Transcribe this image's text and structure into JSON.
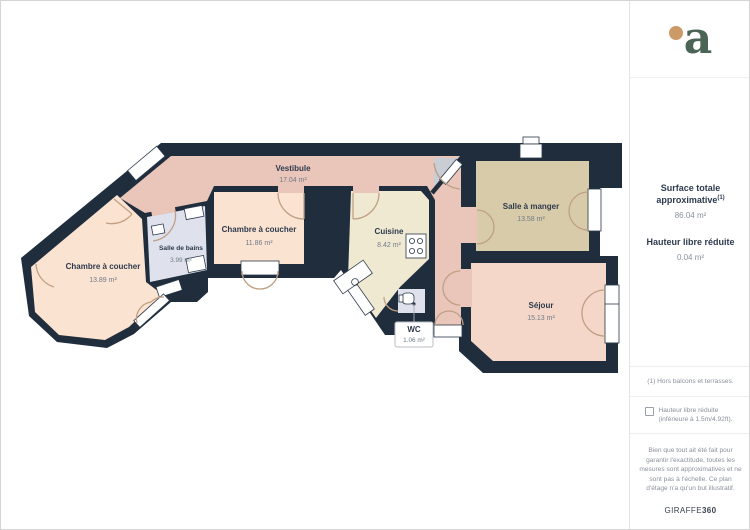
{
  "rooms": [
    {
      "name": "Vestibule",
      "area": "17.04 m²"
    },
    {
      "name": "Chambre à coucher",
      "area": "11.86 m²"
    },
    {
      "name": "Chambre à coucher",
      "area": "13.89 m²"
    },
    {
      "name": "Salle de bains",
      "area": "3.99 m²"
    },
    {
      "name": "Cuisine",
      "area": "8.42 m²"
    },
    {
      "name": "Salle à manger",
      "area": "13.58 m²"
    },
    {
      "name": "Séjour",
      "area": "15.13 m²"
    },
    {
      "name": "WC",
      "area": "1.06 m²"
    }
  ],
  "sidebar": {
    "logo_letter": "a",
    "surface_label": "Surface totale approximative",
    "surface_sup": "(1)",
    "surface_value": "86.04 m²",
    "height_label": "Hauteur libre réduite",
    "height_value": "0.04 m²",
    "footnote": "(1) Hors balcons et terrasses.",
    "checkbox_label": "Hauteur libre réduite (inférieure à 1.5m/4.92ft).",
    "disclaimer": "Bien que tout ait été fait pour garantir l'exactitude, toutes les mesures sont approximatives et ne sont pas à l'échelle. Ce plan d'étage n'a qu'un but illustratif.",
    "brand_name": "GIRAFFE",
    "brand_suffix": "360"
  },
  "colors": {
    "walls": "#202d3d",
    "bedroom": "#fbe3d1",
    "vestibule": "#e9c6b9",
    "kitchen": "#efe9d2",
    "dining": "#d8cbaa",
    "living": "#f4d7c8",
    "wet": "#dfe2ec",
    "entry": "#c9cdd4",
    "logo_green": "#4a6455",
    "logo_orange": "#cb9a66"
  }
}
